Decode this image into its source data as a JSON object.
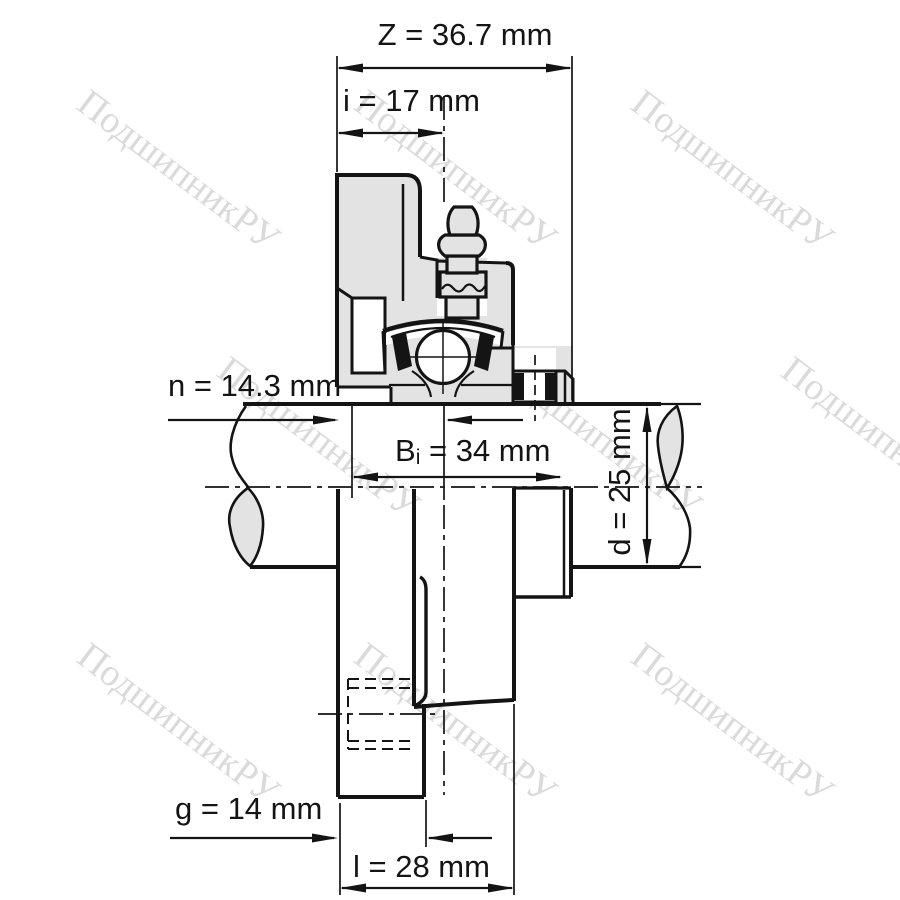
{
  "drawing": {
    "kind": "flanged bearing unit cross-section",
    "dimensions": {
      "Z": {
        "label": "Z = 36.7 mm",
        "value_mm": 36.7
      },
      "i": {
        "label": "i = 17 mm",
        "value_mm": 17
      },
      "n": {
        "label": "n = 14.3 mm",
        "value_mm": 14.3
      },
      "Bi": {
        "prefix": "B",
        "sub": "i",
        "rest": " = 34 mm",
        "value_mm": 34
      },
      "d": {
        "label": "d = 25 mm",
        "value_mm": 25
      },
      "g": {
        "label": "g = 14 mm",
        "value_mm": 14
      },
      "l": {
        "label": "l = 28 mm",
        "value_mm": 28
      }
    }
  },
  "watermark": {
    "text": "ПодшипникРУ"
  },
  "colors": {
    "background": "#ffffff",
    "line": "#141414",
    "body_fill": "#e3e3e3",
    "watermark": "#dadada"
  }
}
